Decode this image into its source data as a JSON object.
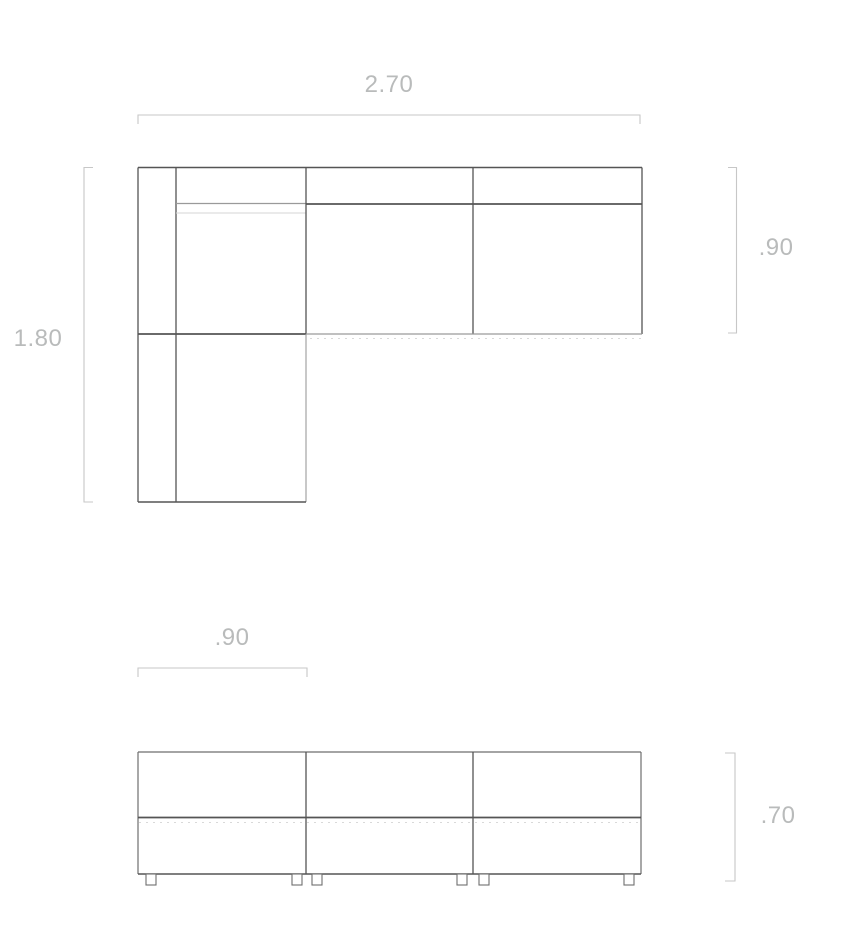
{
  "drawing": {
    "plan_view": {
      "overall_width_label": "2.70",
      "overall_depth_label": "1.80",
      "sofa_depth_label": ".90"
    },
    "elevation_view": {
      "module_width_label": ".90",
      "overall_height_label": ".70"
    },
    "colors": {
      "background": "#ffffff",
      "outline_dark": "#555555",
      "outline_soft": "#6e6e6e",
      "outline_medium": "#9a9a9a",
      "outline_faint": "#d6d6d6",
      "hidden_dash": "#d9d9d9",
      "dimension_line": "#c7c7c7",
      "dimension_text": "#b9bbbb"
    }
  }
}
